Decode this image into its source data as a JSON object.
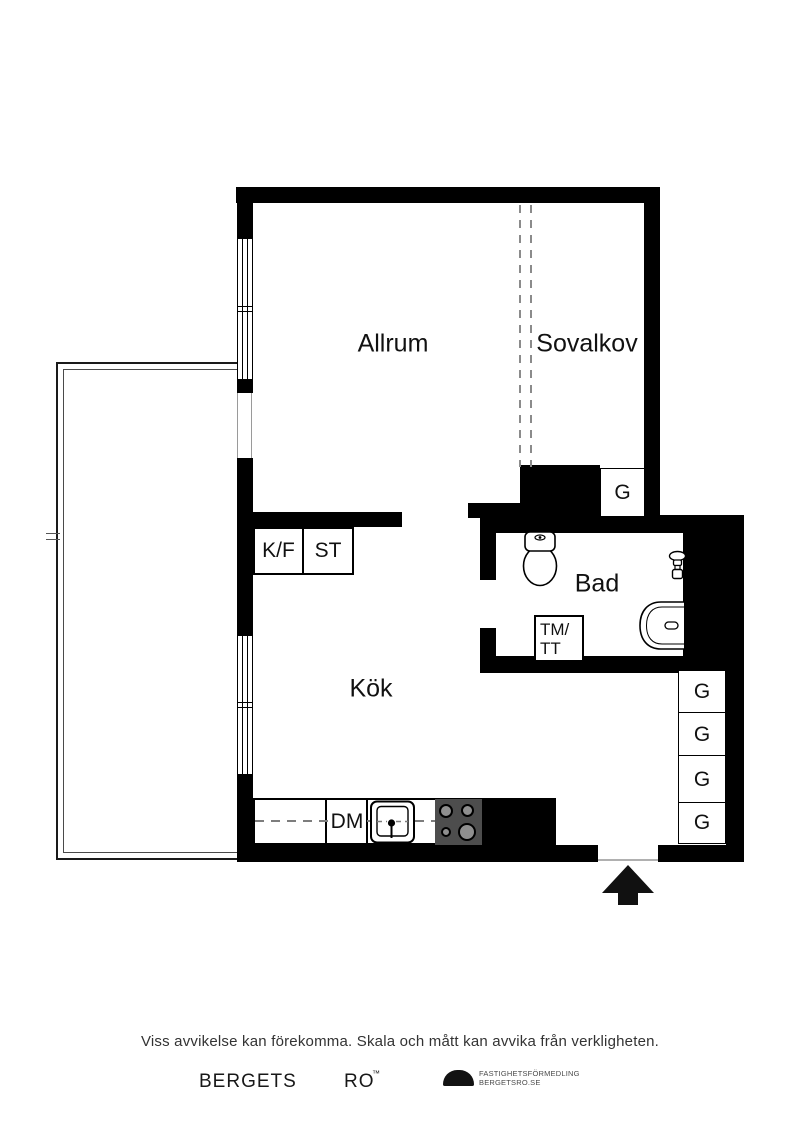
{
  "plan": {
    "rooms": {
      "allrum": "Allrum",
      "sovalkov": "Sovalkov",
      "bad": "Bad",
      "kok": "Kök"
    },
    "fixtures": {
      "kf": "K/F",
      "st": "ST",
      "dm": "DM",
      "tm_line1": "TM/",
      "tm_line2": "TT",
      "g_sovalkov": "G",
      "g_column": [
        "G",
        "G",
        "G",
        "G"
      ]
    }
  },
  "footer": {
    "disclaimer": "Viss avvikelse kan förekomma. Skala och mått kan avvika från verkligheten.",
    "brand_word1": "BERGETS",
    "brand_word2": "RO",
    "brand_mark": "™",
    "agency_line1": "FASTIGHETSFÖRMEDLING",
    "agency_line2": "BERGETSRO.SE"
  },
  "colors": {
    "wall": "#000000",
    "stove_body": "#4d4d4d",
    "burner": "#8f8f8f",
    "dash": "#7d7d7d"
  }
}
